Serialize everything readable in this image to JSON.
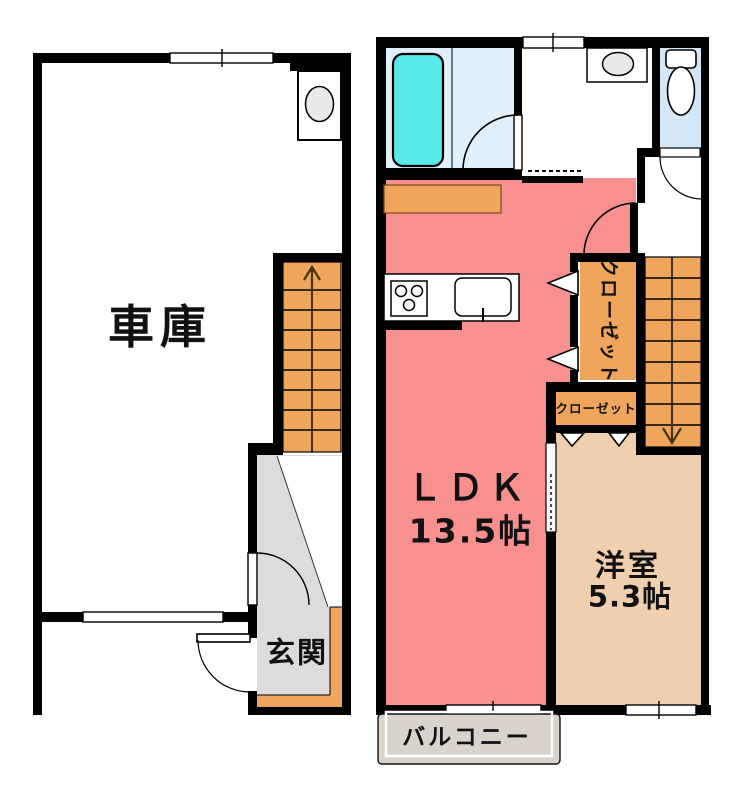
{
  "floor1": {
    "rooms": {
      "garage": {
        "label": "車庫"
      },
      "entrance": {
        "label": "玄関"
      }
    },
    "features": {
      "stairs_direction": "up"
    }
  },
  "floor2": {
    "rooms": {
      "ldk": {
        "label": "ＬＤＫ",
        "size": "13.5帖"
      },
      "western_room": {
        "label": "洋室",
        "size": "5.3帖"
      },
      "closet_large": {
        "label": "クローゼット"
      },
      "closet_small": {
        "label": "クローゼット"
      },
      "balcony": {
        "label": "バルコニー"
      }
    },
    "features": {
      "stairs_direction": "down"
    }
  },
  "colors": {
    "wall": "#000000",
    "ldk_floor": "#f7908e",
    "western_floor": "#efcfae",
    "closet_stairs": "#efa55c",
    "entrance_floor": "#dcdcdc",
    "balcony_floor": "#d9d3cb",
    "bathtub": "#58e9e9",
    "bathroom_floor": "#e0effa",
    "toilet_floor": "#d3e7f7",
    "fixture_gray": "#e9e9e9",
    "stair_arrow": "#4a3512"
  }
}
